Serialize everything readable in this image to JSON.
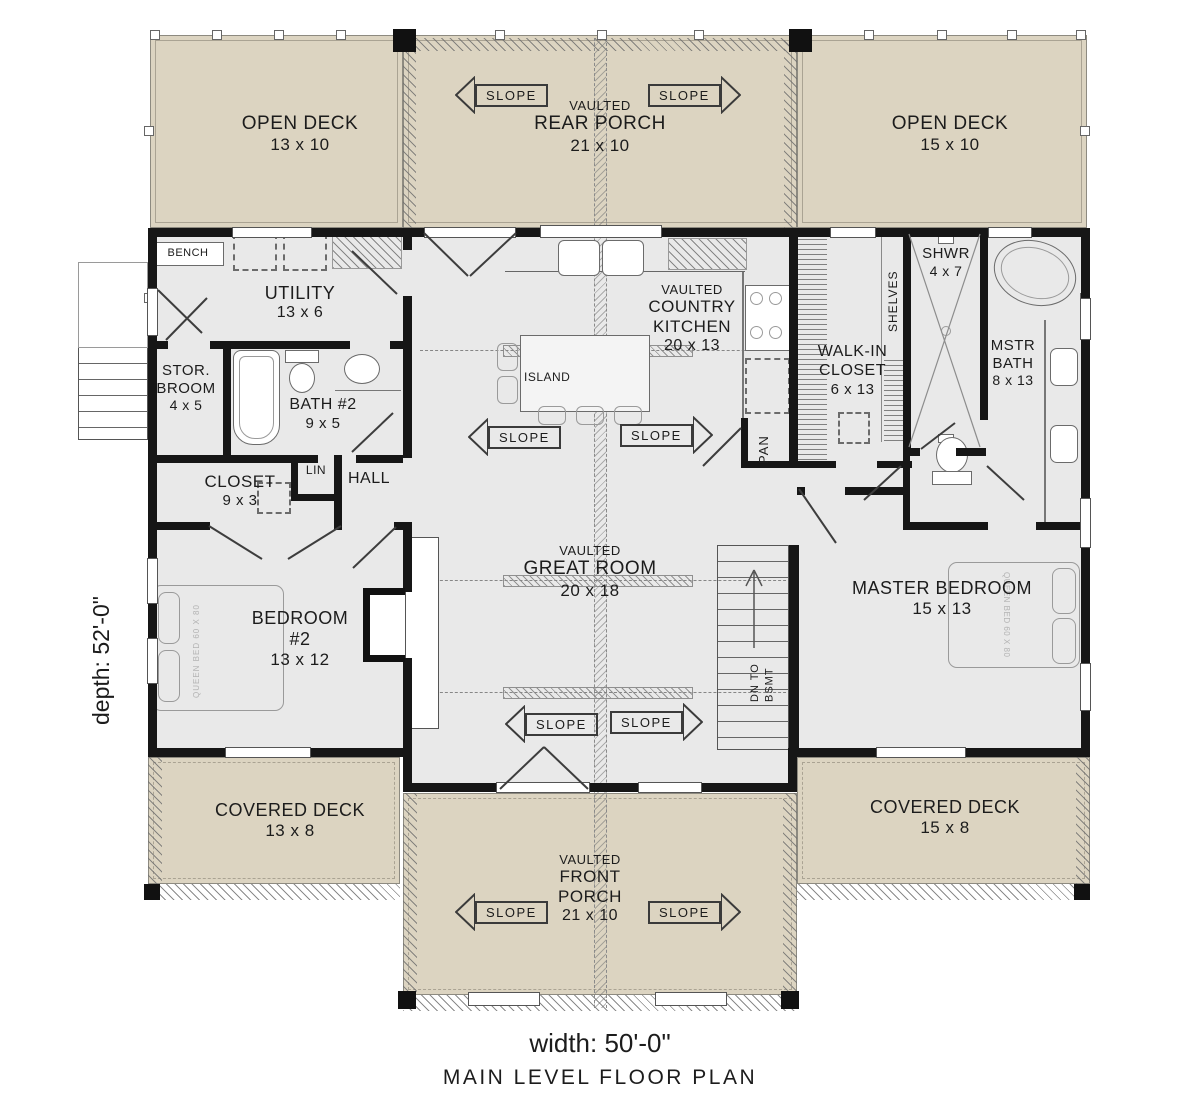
{
  "colors": {
    "deck_fill": "#dcd4c1",
    "floor_fill": "#e9e9e9",
    "wall": "#161616",
    "text": "#1c1c1c"
  },
  "slope_label": "SLOPE",
  "plan": {
    "width_label": "width: 50'-0\"",
    "depth_label": "depth: 52'-0\"",
    "title": "MAIN LEVEL FLOOR PLAN"
  },
  "rooms": {
    "open_deck_left": {
      "name": "OPEN DECK",
      "dims": "13 x 10"
    },
    "rear_porch": {
      "prefix": "VAULTED",
      "name": "REAR PORCH",
      "dims": "21 x 10"
    },
    "open_deck_right": {
      "name": "OPEN DECK",
      "dims": "15 x 10"
    },
    "utility": {
      "name": "UTILITY",
      "dims": "13 x 6"
    },
    "bench": {
      "name": "BENCH"
    },
    "stor_broom": {
      "line1": "STOR.",
      "line2": "BROOM",
      "dims": "4 x 5"
    },
    "bath2": {
      "name": "BATH #2",
      "dims": "9 x 5"
    },
    "closet": {
      "name": "CLOSET",
      "dims": "9 x 3"
    },
    "lin": {
      "name": "LIN"
    },
    "hall": {
      "name": "HALL"
    },
    "bedroom2": {
      "name": "BEDROOM",
      "num": "#2",
      "dims": "13 x 12"
    },
    "kitchen": {
      "prefix": "VAULTED",
      "line1": "COUNTRY",
      "line2": "KITCHEN",
      "dims": "20 x 13"
    },
    "island": {
      "name": "ISLAND"
    },
    "pantry": {
      "name": "PAN"
    },
    "walk_in_closet": {
      "line1": "WALK-IN",
      "line2": "CLOSET",
      "dims": "6 x 13"
    },
    "shelves": {
      "name": "SHELVES"
    },
    "shower": {
      "name": "SHWR",
      "dims": "4 x 7"
    },
    "master_bath": {
      "line1": "MSTR",
      "line2": "BATH",
      "dims": "8 x 13"
    },
    "great_room": {
      "prefix": "VAULTED",
      "name": "GREAT ROOM",
      "dims": "20 x 18"
    },
    "master_bedroom": {
      "name": "MASTER BEDROOM",
      "dims": "15 x 13"
    },
    "stairs": {
      "line1": "DN TO",
      "line2": "BSMT"
    },
    "covered_deck_left": {
      "name": "COVERED DECK",
      "dims": "13 x 8"
    },
    "front_porch": {
      "prefix": "VAULTED",
      "line1": "FRONT",
      "line2": "PORCH",
      "dims": "21 x 10"
    },
    "covered_deck_right": {
      "name": "COVERED DECK",
      "dims": "15 x 8"
    }
  },
  "annotations": {
    "bed_note": "QUEEN BED 60 X 80"
  }
}
